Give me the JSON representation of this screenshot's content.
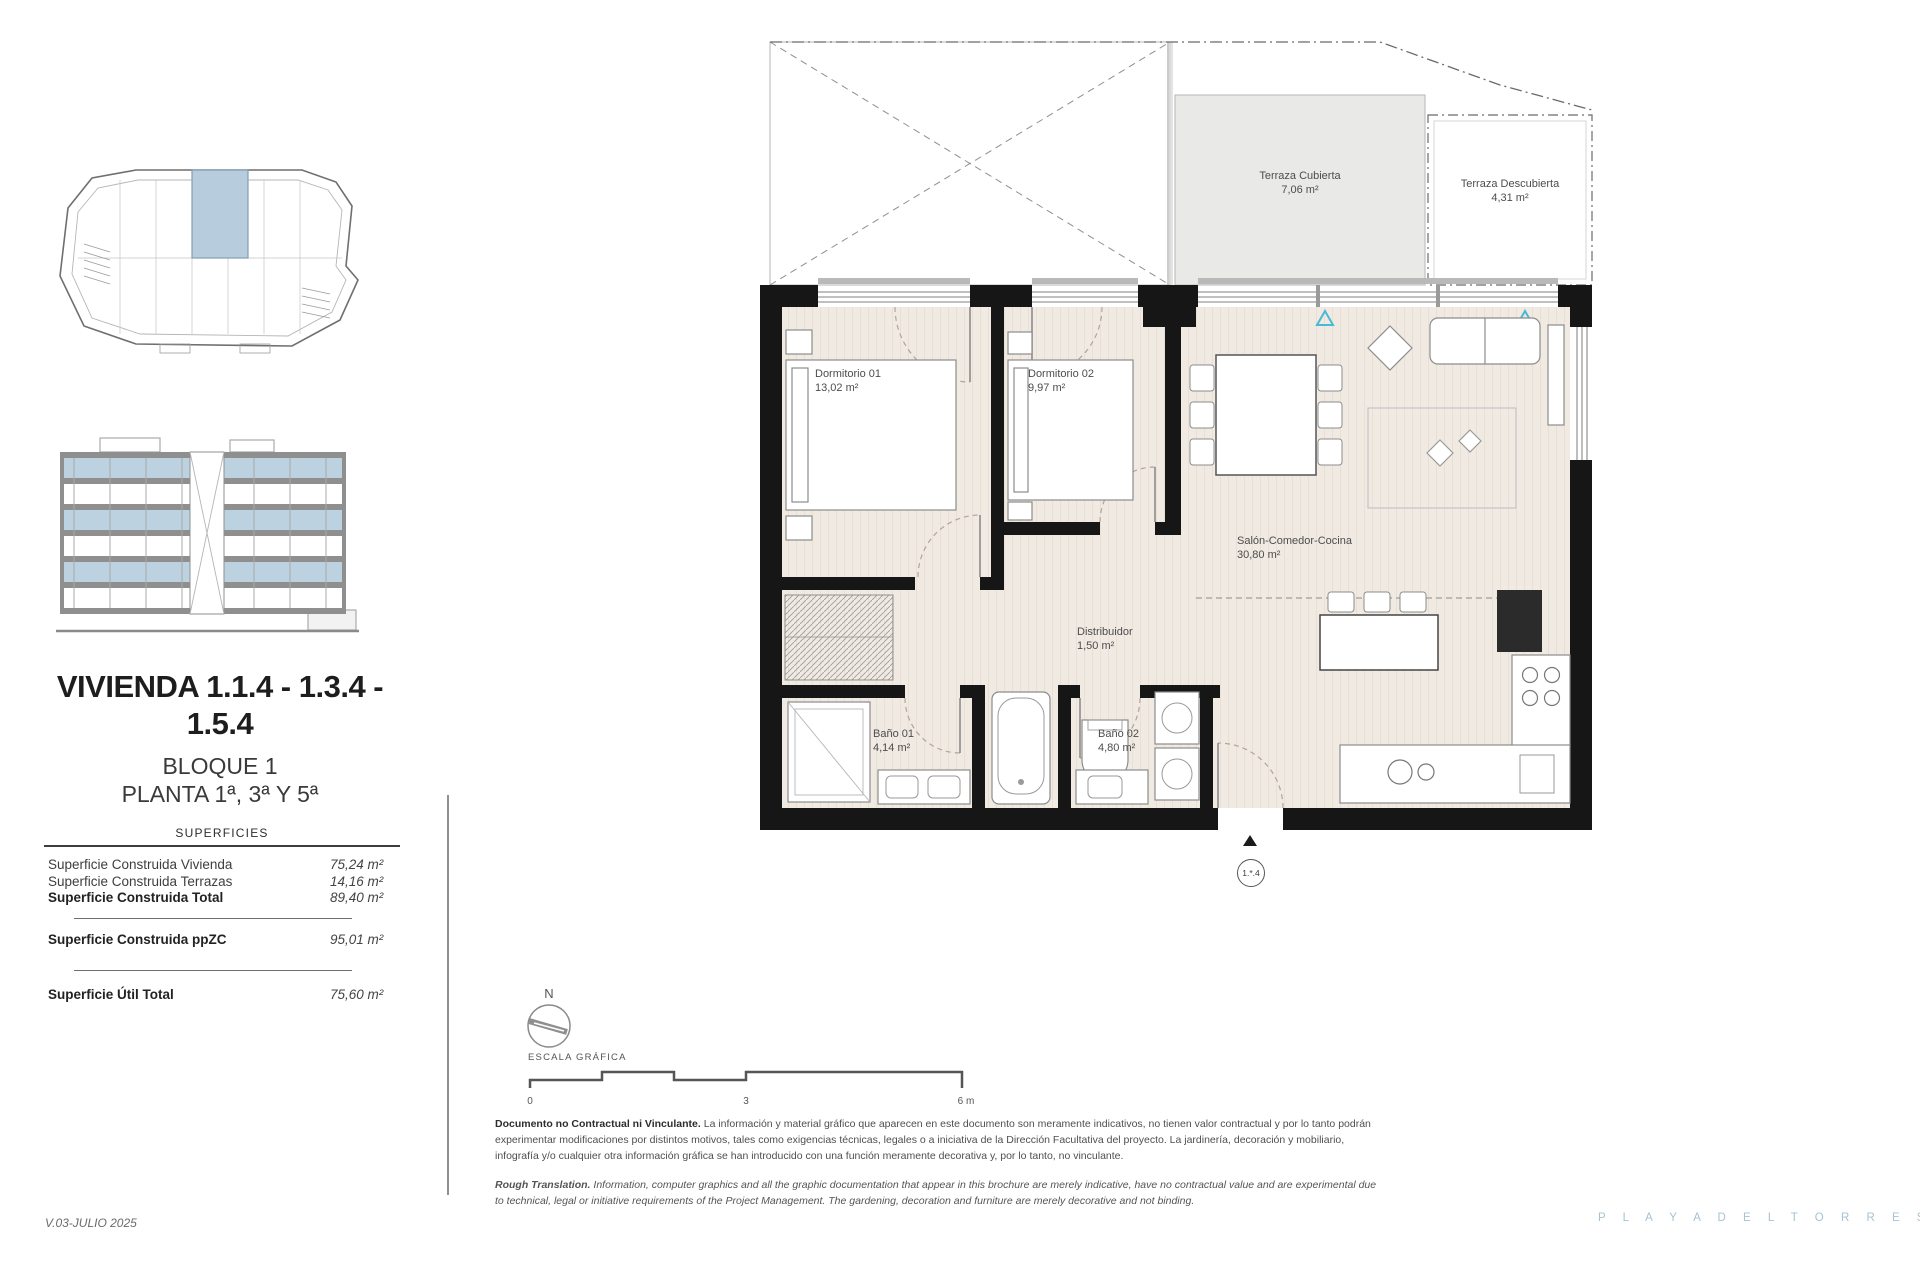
{
  "page": {
    "version": "V.03-JULIO 2025",
    "brand": "P L A Y A   D E L   T O R R E S"
  },
  "sidebar": {
    "title_line1": "VIVIENDA 1.1.4 - 1.3.4 -",
    "title_line2": "1.5.4",
    "block": "BLOQUE 1",
    "floors": "PLANTA 1ª, 3ª Y 5ª",
    "surfaces_header": "SUPERFICIES",
    "surfaces": [
      {
        "label": "Superficie Construida Vivienda",
        "value": "75,24 m²"
      },
      {
        "label": "Superficie Construida Terrazas",
        "value": "14,16 m²"
      },
      {
        "label": "Superficie Construida Total",
        "value": "89,40 m²"
      },
      {
        "label": "Superficie Construida ppZC",
        "value": "95,01 m²"
      },
      {
        "label": "Superficie Útil Total",
        "value": "75,60 m²"
      }
    ]
  },
  "plan": {
    "rooms": {
      "dormitorio1": {
        "name": "Dormitorio 01",
        "area": "13,02 m²"
      },
      "dormitorio2": {
        "name": "Dormitorio 02",
        "area": "9,97 m²"
      },
      "salon": {
        "name": "Salón-Comedor-Cocina",
        "area": "30,80 m²"
      },
      "distribuidor": {
        "name": "Distribuidor",
        "area": "1,50 m²"
      },
      "bano1": {
        "name": "Baño 01",
        "area": "4,14 m²"
      },
      "bano2": {
        "name": "Baño 02",
        "area": "4,80 m²"
      },
      "terraza_cubierta": {
        "name": "Terraza Cubierta",
        "area": "7,06 m²"
      },
      "terraza_descubierta": {
        "name": "Terraza Descubierta",
        "area": "4,31 m²"
      }
    },
    "unit_marker": "1.*.4",
    "compass": "N",
    "scale_label": "ESCALA GRÁFICA",
    "scale_ticks": {
      "start": "0",
      "mid": "3",
      "end": "6 m"
    }
  },
  "disclaimer": {
    "es_lead": "Documento no Contractual ni Vinculante.",
    "es_body": "La información y material gráfico que aparecen en este documento son meramente indicativos, no tienen valor contractual y por lo tanto podrán experimentar modificaciones por distintos motivos, tales como exigencias técnicas, legales o a iniciativa de la Dirección Facultativa del proyecto. La jardinería, decoración y mobiliario, infografía y/o cualquier otra información gráfica se han introducido con una función meramente decorativa y, por lo tanto, no vinculante.",
    "en_lead": "Rough Translation.",
    "en_body": "Information, computer graphics and all the graphic documentation that appear in this brochure are merely indicative, have no contractual value and are experimental due to technical, legal or initiative requirements of the Project Management. The gardening, decoration and furniture are merely decorative and not binding."
  }
}
